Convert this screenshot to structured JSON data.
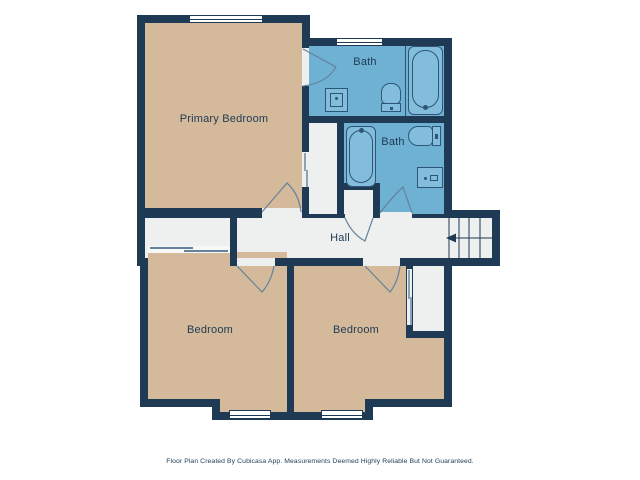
{
  "floorplan": {
    "rooms": {
      "primary_bedroom": {
        "label": "Primary Bedroom"
      },
      "bath_top": {
        "label": "Bath"
      },
      "bath_mid": {
        "label": "Bath"
      },
      "hall": {
        "label": "Hall"
      },
      "bedroom_left": {
        "label": "Bedroom"
      },
      "bedroom_right": {
        "label": "Bedroom"
      }
    },
    "symbols": {
      "stairs_arrow": "left-arrow",
      "fixtures": [
        "bathtub",
        "toilet",
        "sink",
        "door-swing",
        "sliding-door",
        "window",
        "stairs"
      ]
    },
    "colors": {
      "wall": "#1e3a54",
      "room_tan": "#d4ba9a",
      "room_blue": "#6fb1d3",
      "room_light": "#eeefef",
      "fixture_blue": "#82bedb",
      "fixture_line": "#2e5578",
      "symbol_line": "#64829c",
      "window_fill": "#ffffff",
      "label_text": "#1e3a54"
    },
    "footer": "Floor Plan Created By Cubicasa App. Measurements Deemed Highly Reliable But Not Guaranteed."
  }
}
